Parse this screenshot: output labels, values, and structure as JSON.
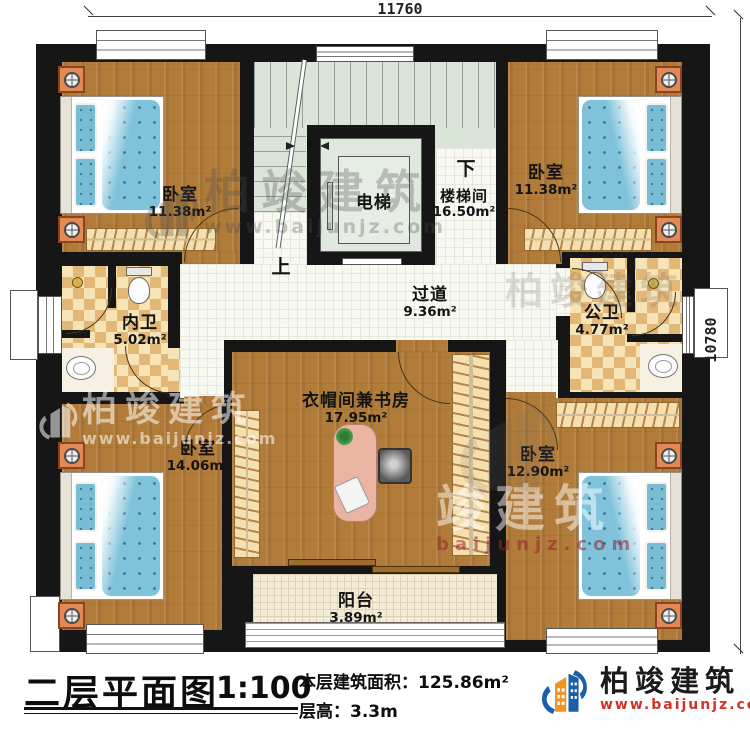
{
  "dimensions": {
    "top": "11760",
    "right": "10780"
  },
  "stairs": {
    "up": "上",
    "down": "下"
  },
  "rooms": {
    "bedroom_tl": {
      "name": "卧室",
      "area": "11.38m²"
    },
    "bedroom_tr": {
      "name": "卧室",
      "area": "11.38m²"
    },
    "elevator": {
      "name": "电梯"
    },
    "stairwell": {
      "name": "楼梯间",
      "area": "16.50m²"
    },
    "hallway": {
      "name": "过道",
      "area": "9.36m²"
    },
    "bath_inner": {
      "name": "内卫",
      "area": "5.02m²"
    },
    "bath_public": {
      "name": "公卫",
      "area": "4.77m²"
    },
    "study": {
      "name": "衣帽间兼书房",
      "area": "17.95m²"
    },
    "bedroom_bl": {
      "name": "卧室",
      "area": "14.06m²"
    },
    "bedroom_br": {
      "name": "卧室",
      "area": "12.90m²"
    },
    "balcony": {
      "name": "阳台",
      "area": "3.89m²"
    }
  },
  "title_block": {
    "title": "二层平面图",
    "scale": "1:100",
    "floor_area_label": "本层建筑面积：",
    "floor_area_value": "125.86m²",
    "floor_height_label": "层高：",
    "floor_height_value": "3.3m"
  },
  "branding": {
    "company": "柏竣建筑",
    "website": "www.baijunjz.com"
  },
  "watermarks": {
    "wm1": {
      "text": "柏竣建筑",
      "url": "www.baijunjz.com"
    },
    "wm2": {
      "text": "柏竣建筑",
      "url": "www.baijunjz.com"
    },
    "wm3": {
      "text": "竣建筑",
      "url": "baijunjz.com"
    },
    "wm4": {
      "text": "柏竣建筑"
    }
  },
  "colors": {
    "accent_blue": "#1a5fa8",
    "accent_orange": "#f29422",
    "url_red": "#cf3427"
  }
}
